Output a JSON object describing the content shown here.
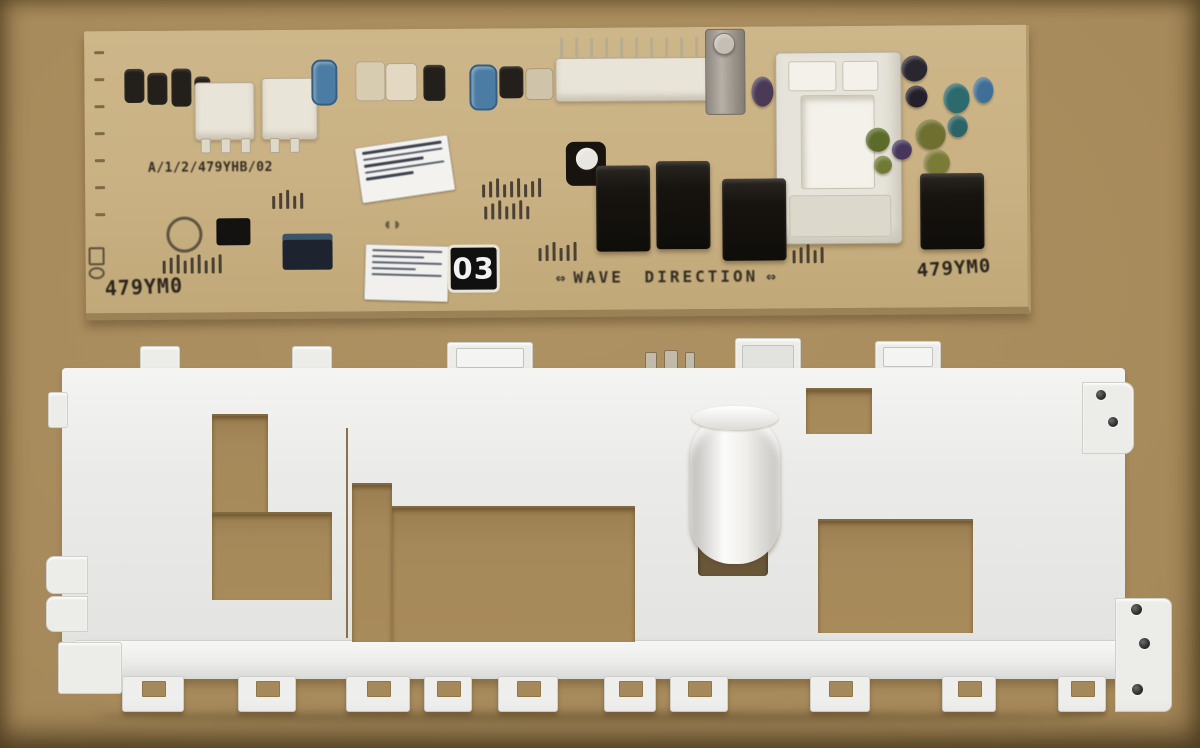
{
  "meta": {
    "description": "Photograph of a washing-machine electronic control PCB lying on cardboard above its white plastic control-panel mounting bracket"
  },
  "colors": {
    "cardboard": "#a6895a",
    "cardboard_light": "#ae9263",
    "pcb_board": "#c9b183",
    "pcb_edge": "#9b8156",
    "bracket_white": "#ebebe9",
    "relay_black": "#17140f",
    "cap_blue": "#4b7ca3",
    "cap_teal": "#2c6a6d",
    "cap_olive": "#6f7030",
    "cap_purple": "#4a3a56",
    "label_bg": "#101010",
    "label_text": "#f2f2f0",
    "silk_text": "#332e22"
  },
  "pcb": {
    "labels": {
      "model_code": "A/1/2/479YHB/02",
      "part_number_left": "479YM0",
      "part_number_right": "479YM0",
      "wave_direction": "WAVE DIRECTION",
      "wave_arrow": "⇔",
      "version_badge": "03"
    },
    "stickers": [
      {
        "name": "barcode-sticker-top"
      },
      {
        "name": "serial-sticker-bottom"
      }
    ],
    "components": {
      "power_relays": 4,
      "white_connectors": 3,
      "pin_header": 1,
      "power_module": 1,
      "metal_bracket_post": 1,
      "capacitor_colors": [
        "blue",
        "blue",
        "blue",
        "teal",
        "teal",
        "olive",
        "olive",
        "purple",
        "purple",
        "black",
        "black-white-top",
        "green"
      ],
      "ics": [
        "black-ic",
        "mcu"
      ]
    }
  },
  "bracket": {
    "description": "White plastic mounting bracket / control panel frame",
    "screw_holes_top_right": 2,
    "screw_holes_bottom_right": 3,
    "cutouts": 5,
    "cylinder_feature": 1
  }
}
